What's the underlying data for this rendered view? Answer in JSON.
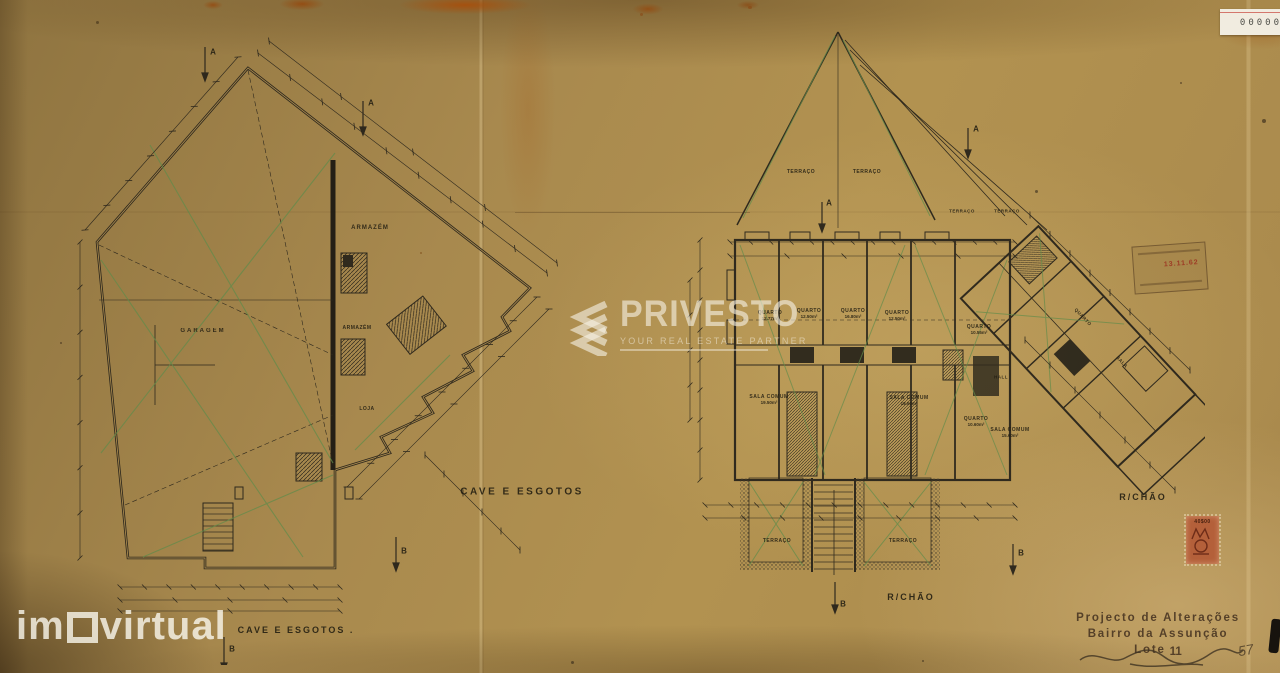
{
  "watermarks": {
    "privesto": {
      "brand": "PRIVESTO",
      "tagline": "YOUR REAL ESTATE PARTNER"
    },
    "imovirtual": {
      "prefix": "im",
      "suffix": "virtual"
    }
  },
  "plans": {
    "left": {
      "caption_mid": "CAVE E ESGOTOS",
      "caption_bottom": "CAVE E ESGOTOS .",
      "labels": [
        {
          "text": "ARMAZÉM"
        },
        {
          "text": "GARAGEM"
        },
        {
          "text": "ARMAZÉM"
        },
        {
          "text": "LOJA"
        }
      ],
      "markers": {
        "a": "A",
        "b": "B"
      }
    },
    "right": {
      "caption_bottom": "R/CHÃO",
      "caption_side": "R/CHÃO",
      "labels": [
        {
          "text": "TERRAÇO"
        },
        {
          "text": "TERRAÇO"
        },
        {
          "text": "TERRAÇO"
        },
        {
          "text": "TERRAÇO"
        },
        {
          "text": "QUARTO",
          "area": "12.77m²"
        },
        {
          "text": "QUARTO",
          "area": "12.50m²"
        },
        {
          "text": "QUARTO",
          "area": "16.80m²"
        },
        {
          "text": "QUARTO",
          "area": "12.50m²"
        },
        {
          "text": "QUARTO",
          "area": "10.55m²"
        },
        {
          "text": "HALL"
        },
        {
          "text": "SALA COMUM",
          "area": "19.50m²"
        },
        {
          "text": "SALA COMUM",
          "area": "19.50m²"
        },
        {
          "text": "QUARTO",
          "area": "10.60m²"
        },
        {
          "text": "SALA COMUM",
          "area": "15.60m²"
        },
        {
          "text": "QUARTO"
        },
        {
          "text": "SALA"
        },
        {
          "text": "TERRAÇO"
        },
        {
          "text": "TERRAÇO"
        }
      ],
      "markers": {
        "a": "A",
        "b": "B"
      }
    }
  },
  "title_block": {
    "line1": "Projecto de Alterações",
    "line2": "Bairro da Assunção",
    "line3_prefix": "Lote",
    "lot_number": "11",
    "handwritten_note": "57"
  },
  "stamps": {
    "sticker": {
      "digits": "00000"
    },
    "ink_stamp": {
      "date": "13.11.62"
    },
    "fiscal": {
      "value": "40$00"
    }
  },
  "colors": {
    "paper": "#a8894e",
    "ink": "#26221a",
    "drain_green": "#5e8c4b",
    "stain_rust": "#a4540e",
    "watermark_white": "#f5efe2",
    "fiscal_stamp": "#b4603a",
    "sticker_red": "#c84a42"
  }
}
